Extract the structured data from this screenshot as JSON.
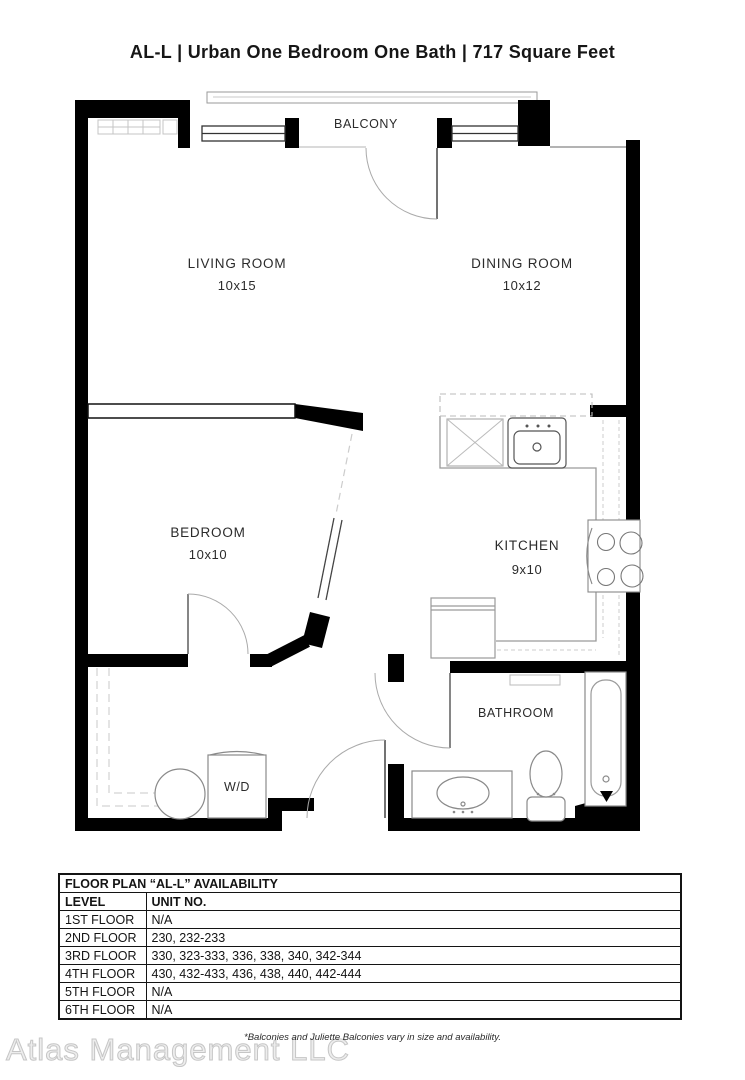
{
  "page": {
    "title": "AL-L | Urban One Bedroom One Bath | 717  Square Feet"
  },
  "floorplan": {
    "balcony_label": "BALCONY",
    "rooms": {
      "living": {
        "name": "LIVING ROOM",
        "dims": "10x15"
      },
      "dining": {
        "name": "DINING ROOM",
        "dims": "10x12"
      },
      "bedroom": {
        "name": "BEDROOM",
        "dims": "10x10"
      },
      "kitchen": {
        "name": "KITCHEN",
        "dims": "9x10"
      },
      "bathroom": {
        "name": "BATHROOM"
      },
      "washer_dryer": {
        "label": "W/D"
      }
    },
    "colors": {
      "wall": "#000000",
      "fixture_line": "#8a8a8a",
      "light_line": "#c9c9c9"
    }
  },
  "availability": {
    "title": "FLOOR PLAN “AL-L” AVAILABILITY",
    "columns": {
      "level": "LEVEL",
      "unit": "UNIT NO."
    },
    "rows": [
      {
        "level": "1ST FLOOR",
        "units": "N/A"
      },
      {
        "level": "2ND FLOOR",
        "units": "230, 232-233"
      },
      {
        "level": "3RD FLOOR",
        "units": "330, 323-333, 336, 338, 340, 342-344"
      },
      {
        "level": "4TH FLOOR",
        "units": "430, 432-433, 436, 438, 440, 442-444"
      },
      {
        "level": "5TH FLOOR",
        "units": "N/A"
      },
      {
        "level": "6TH FLOOR",
        "units": "N/A"
      }
    ]
  },
  "footer": {
    "note": "*Balconies and Juliette Balconies vary in size and availability.",
    "watermark": "Atlas Management LLC"
  }
}
